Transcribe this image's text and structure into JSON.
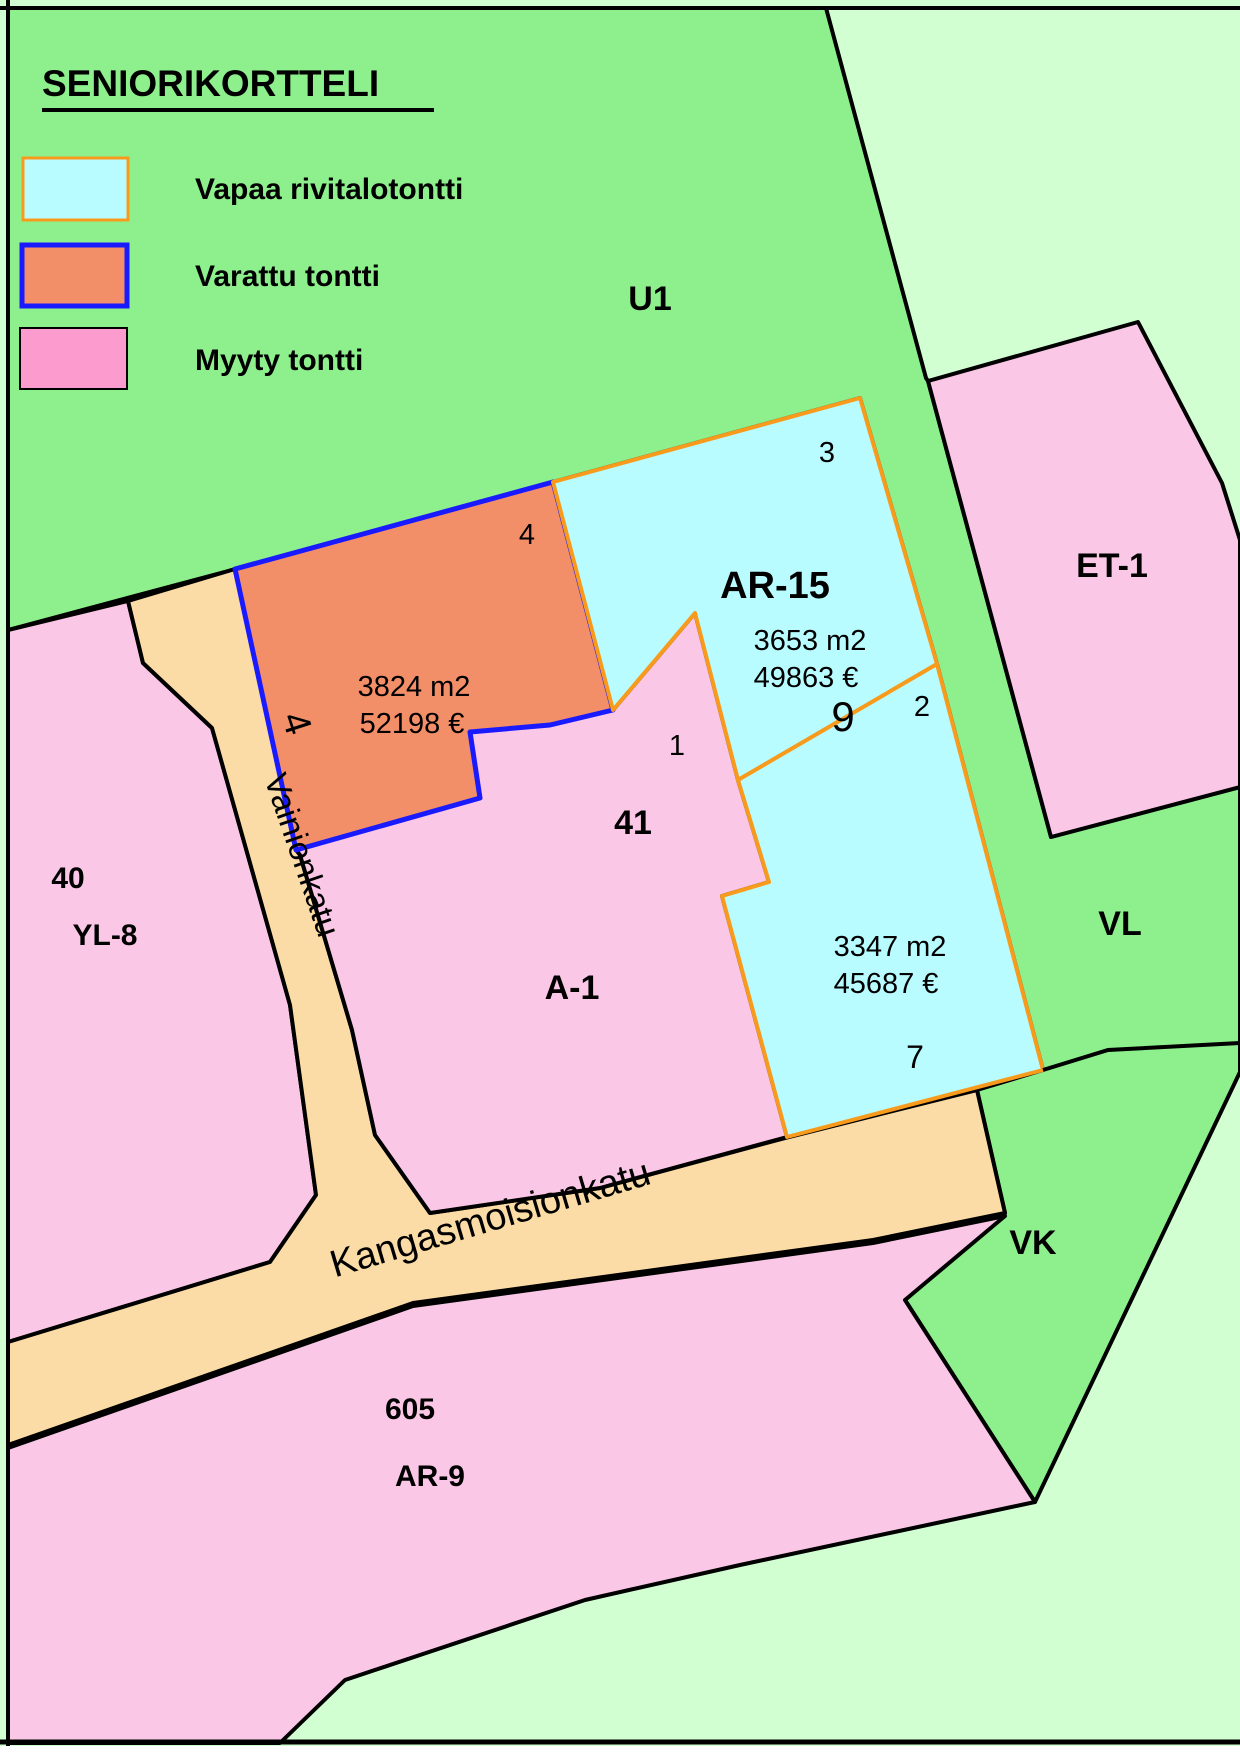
{
  "legend": {
    "title": "SENIORIKORTTELI",
    "items": [
      {
        "label": "Vapaa rivitalotontti"
      },
      {
        "label": "Varattu tontti"
      },
      {
        "label": "Myyty tontti"
      }
    ]
  },
  "areas": {
    "u1": "U1",
    "et1": "ET-1",
    "vl": "VL",
    "vk": "VK",
    "block40": "40",
    "yl8": "YL-8",
    "block605": "605",
    "ar9": "AR-9"
  },
  "block41": {
    "number": "41",
    "zone": "A-1",
    "plot1_number": "1"
  },
  "plots": {
    "ar15": {
      "zone": "AR-15",
      "block_number": "9",
      "plot3_number": "3",
      "area": "3653 m2",
      "price": "49863 €"
    },
    "plot2": {
      "number": "2",
      "address": "7",
      "area": "3347 m2",
      "price": "45687 €"
    },
    "plot4": {
      "number": "4",
      "address": "4",
      "area": "3824 m2",
      "price": "52198 €"
    }
  },
  "streets": {
    "vainionkatu": "Vainionkatu",
    "kangasmoisionkatu": "Kangasmoisionkatu"
  },
  "colors": {
    "green_dark": "#8df08d",
    "green_pale": "#d2ffd2",
    "pink_plot": "#fac8e6",
    "pink_legend": "#fc9bce",
    "orange_plot": "#f28f69",
    "cyan_plot": "#b8fcff",
    "street_tan": "#fbdca6",
    "border_orange": "#f89b1c",
    "border_blue": "#1a1aff",
    "border_black": "#000000",
    "white": "#ffffff"
  }
}
